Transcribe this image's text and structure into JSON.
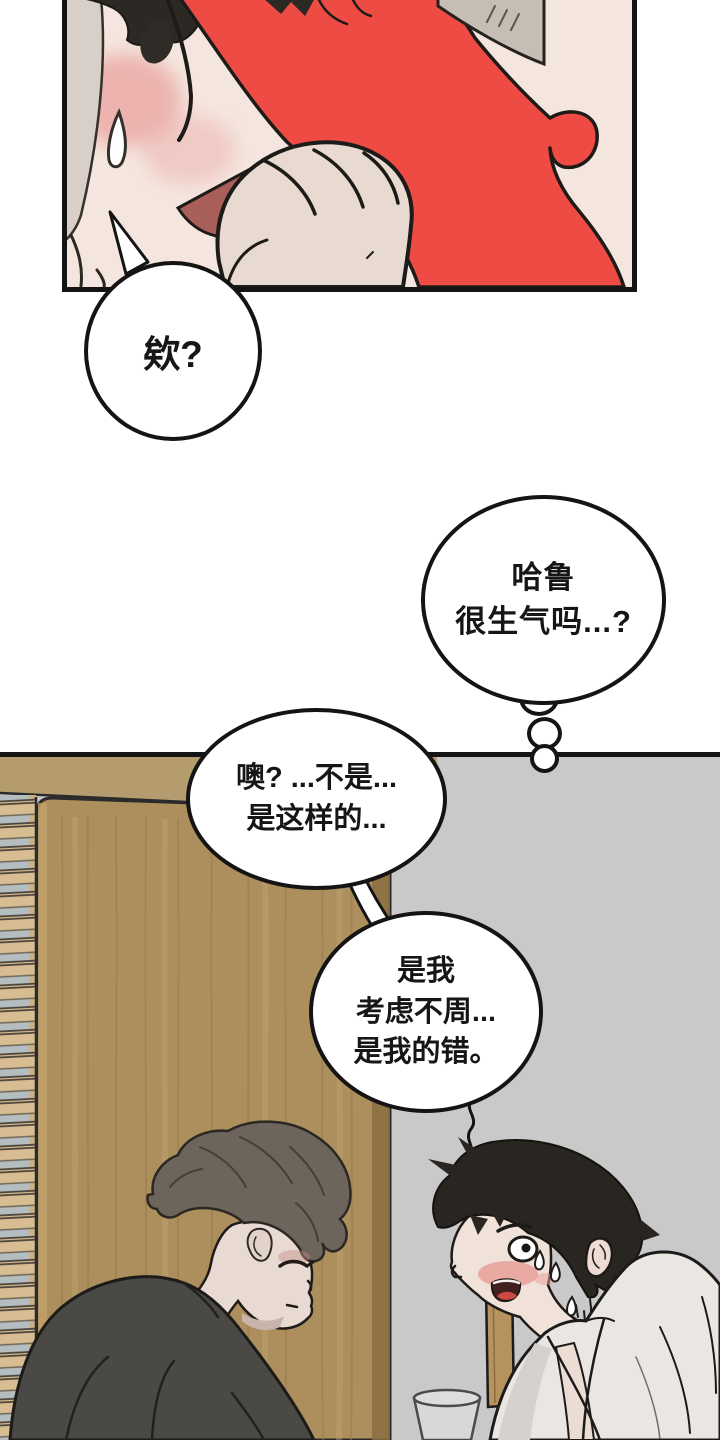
{
  "page": {
    "type": "manhwa-page",
    "panel1_alt": "Close-up: blushing face with sweat drop, a hand clutching red clothing",
    "panel2_alt": "Room scene: man in dark sweater bows his head; flustered smiling man in white bathrobe faces him near window blinds and a wooden door"
  },
  "bubbles": {
    "b1": {
      "text": "欸?"
    },
    "thought": {
      "lines": [
        "哈鲁",
        "很生气吗...?"
      ]
    },
    "b2": {
      "lines": [
        "噢? ...不是...",
        "是这样的..."
      ]
    },
    "b3": {
      "lines": [
        "是我",
        "考虑不周...",
        "是我的错。"
      ]
    }
  },
  "colors": {
    "panel_border": "#141414",
    "red_garment": "#ef4b45",
    "skin": "#f0e2d9",
    "blush": "#e79c95",
    "mouth_dark_red": "#a85e59",
    "wood_door": "#ad8f5d",
    "wood_header": "#b59c6e",
    "blind_slat": "#d9bd92",
    "blind_glass": "#b4bdbf",
    "wall_gray": "#c9c9ca",
    "sweater_gray": "#4b4946",
    "left_hair": "#6d655b",
    "right_hair": "#292520",
    "robe_white": "#eae7e3"
  }
}
